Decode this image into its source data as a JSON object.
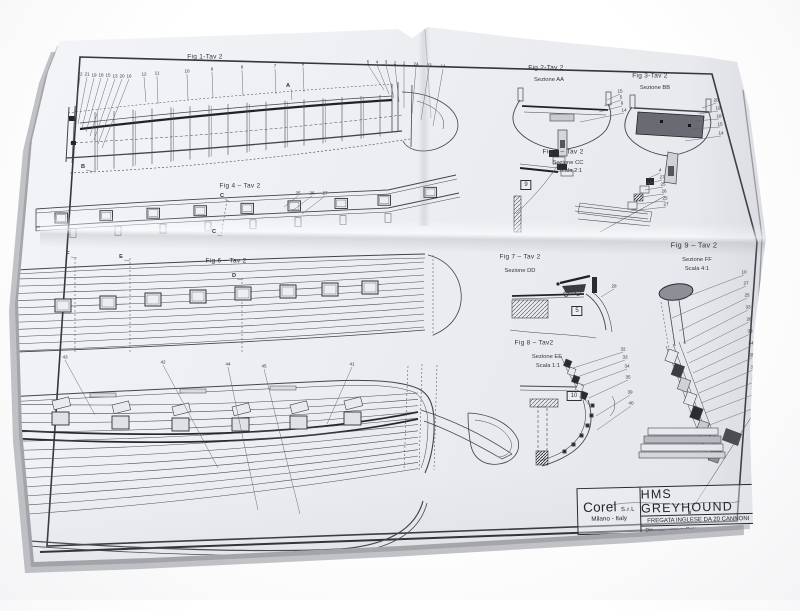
{
  "sheet": {
    "company": "Corel",
    "company_suffix": "S.r.L",
    "company_city": "Milano - Italy",
    "title": "HMS GREYHOUND",
    "subtitle": "FREGATA INGLESE DA 20 CANNONI",
    "fields": {
      "dis": "Dis.",
      "data": "Data",
      "scala": "Scala",
      "scala_value": "1:1"
    }
  },
  "figures": {
    "fig1": {
      "label": "Fig 1-Tav 2",
      "callouts": [
        "22",
        "21",
        "19",
        "18",
        "15",
        "13",
        "20",
        "16",
        "12",
        "11",
        "10",
        "9",
        "8",
        "7",
        "6",
        "5",
        "4",
        "3",
        "2",
        "1",
        "24",
        "23",
        "14"
      ],
      "markers": [
        "A",
        "B"
      ]
    },
    "fig2": {
      "label": "Fig 2-Tav 2",
      "section": "Sezione AA",
      "callouts": [
        "15",
        "5",
        "6",
        "14"
      ]
    },
    "fig3": {
      "label": "Fig 3-Tav 2",
      "section": "Sezione BB",
      "callouts": [
        "20",
        "19",
        "18",
        "15",
        "14"
      ]
    },
    "fig4": {
      "label": "Fig 4 – Tav 2",
      "callouts": [
        "25",
        "26",
        "27"
      ],
      "markers": [
        "C",
        "C"
      ]
    },
    "fig5": {
      "label": "Fig 5 – Tav 2",
      "section": "Sezione CC",
      "scale": "Scala 2:1",
      "box": "9",
      "callouts": [
        "4",
        "27",
        "25",
        "26",
        "25",
        "27"
      ]
    },
    "fig6": {
      "label": "Fig 6 – Tav 2",
      "markers": [
        "D",
        "E",
        "F"
      ]
    },
    "fig7": {
      "label": "Fig 7 – Tav 2",
      "section": "Sezione DD",
      "box": "5",
      "callouts": [
        "28"
      ]
    },
    "fig8": {
      "label": "Fig 8 – Tav2",
      "section": "Sezione EE",
      "scale": "Scala 1:1",
      "box": "10",
      "callouts": [
        "32",
        "33",
        "34",
        "35",
        "39",
        "40"
      ]
    },
    "fig9": {
      "label": "Fig 9 – Tav 2",
      "section": "Sezione FF",
      "scale": "Scala 4:1",
      "callouts": [
        "10",
        "27",
        "25",
        "33",
        "26",
        "33",
        "34",
        "35",
        "36",
        "37",
        "38",
        "10"
      ]
    },
    "hull_bottom": {
      "callouts": [
        "43",
        "42",
        "44",
        "45",
        "41"
      ]
    }
  },
  "colors": {
    "paper": "#ecedf1",
    "ink": "#43444b",
    "ink_dark": "#202126",
    "section_fill": "#6a6b72"
  }
}
